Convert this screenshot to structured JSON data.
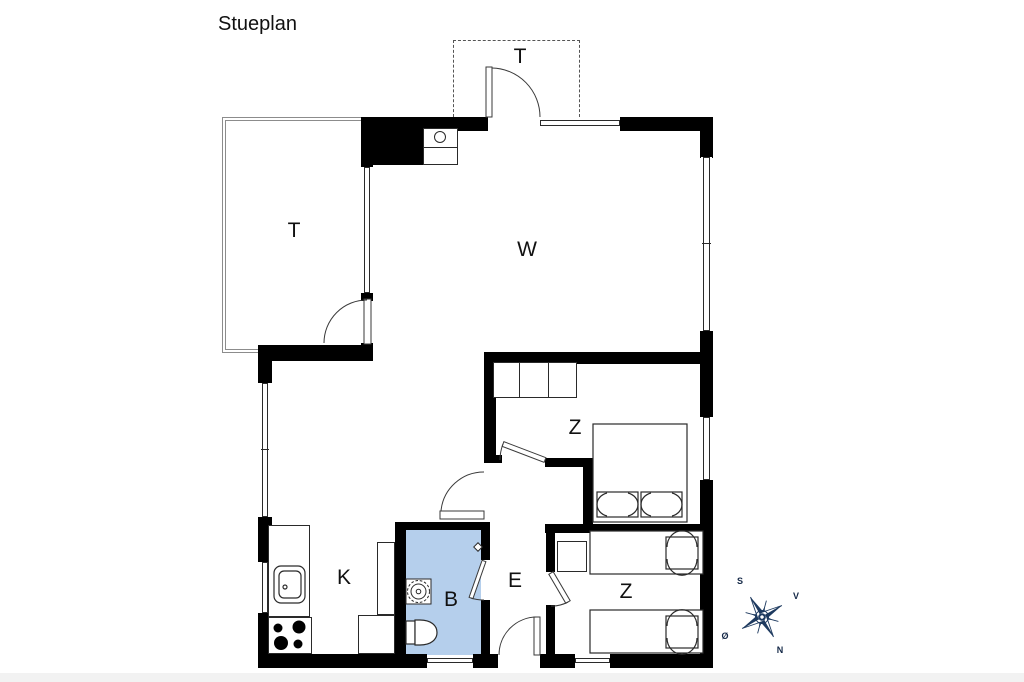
{
  "title": "Stueplan",
  "rooms": {
    "terrace_top": "T",
    "terrace_left": "T",
    "living": "W",
    "bedroom_upper": "Z",
    "bedroom_lower": "Z",
    "entry": "E",
    "bathroom": "B",
    "kitchen": "K"
  },
  "compass": {
    "s": "S",
    "v": "V",
    "n": "N",
    "o": "Ø"
  },
  "colors": {
    "wall": "#000000",
    "bathroom_fill": "#b5cfec",
    "compass_navy": "#1e3a5f"
  }
}
